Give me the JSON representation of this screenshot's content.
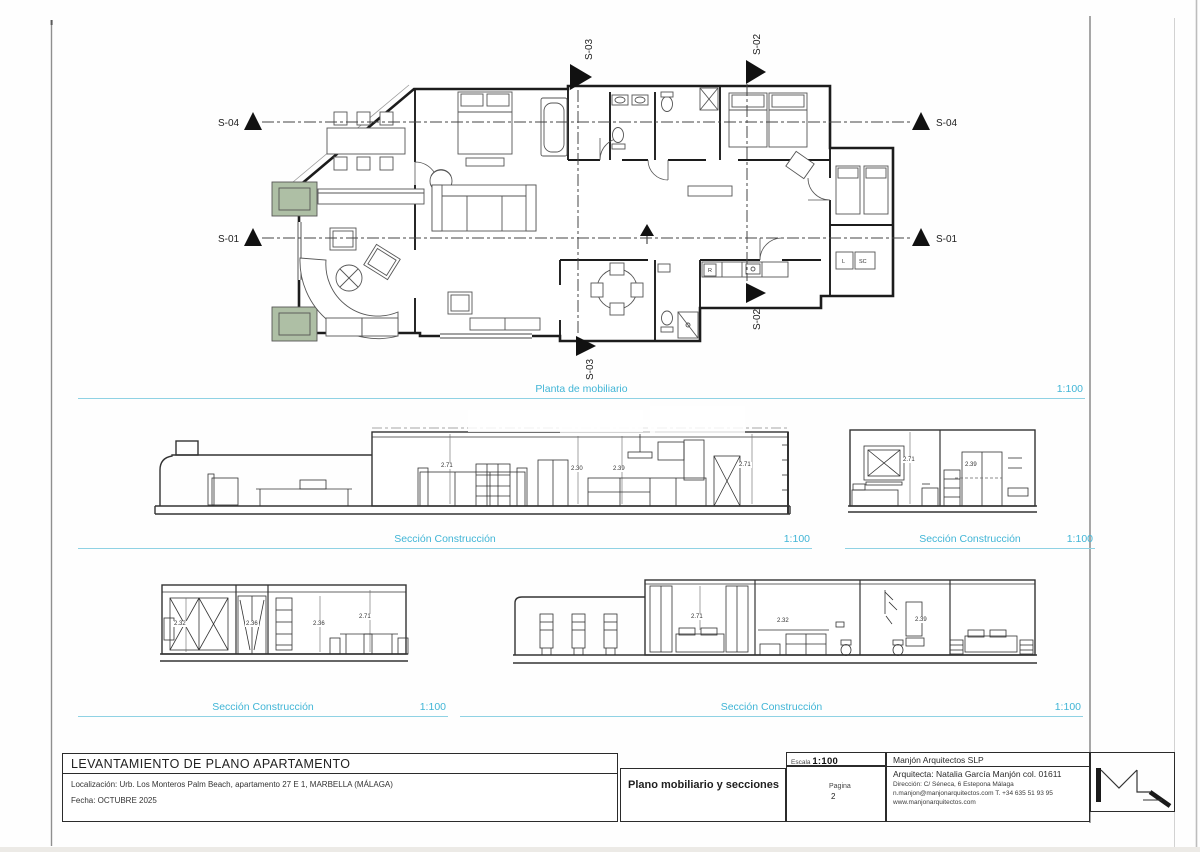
{
  "captions": {
    "plan": {
      "label": "Planta de mobiliario",
      "scale": "1:100"
    },
    "section_a": {
      "label": "Sección Construcción",
      "scale": "1:100"
    },
    "section_b": {
      "label": "Sección Construcción",
      "scale": "1:100"
    },
    "section_c": {
      "label": "Sección Construcción",
      "scale": "1:100"
    },
    "section_d": {
      "label": "Sección Construcción",
      "scale": "1:100"
    }
  },
  "markers": {
    "s01": "S-01",
    "s02": "S-02",
    "s03": "S-03",
    "s04": "S-04"
  },
  "plan_labels": {
    "r": "R",
    "l": "L",
    "sc": "SC"
  },
  "dims": {
    "a": [
      "2.71",
      "2.30",
      "2.39",
      "2.71"
    ],
    "b": [
      "2.71",
      "2.39"
    ],
    "c": [
      "2.32",
      "2.36",
      "2.36",
      "2.71"
    ],
    "d": [
      "2.71",
      "2.32",
      "2.39"
    ]
  },
  "colors": {
    "accent": "#41b5d6",
    "planter": "#aebfa5",
    "ink": "#222222"
  },
  "title_block": {
    "title": "LEVANTAMIENTO DE PLANO APARTAMENTO",
    "location": "Localización:  Urb. Los Monteros Palm Beach, apartamento 27 E 1, MARBELLA (MÁLAGA)",
    "date": "Fecha: OCTUBRE 2025",
    "scale_label": "Escala",
    "scale_value": "1:100",
    "drawing_title": "Plano mobiliario y secciones",
    "page_label": "Pagina",
    "page_number": "2",
    "firm": "Manjón Arquitectos SLP",
    "architect": "Arquitecta: Natalia García Manjón col. 01611",
    "address": "Dirección: C/ Séneca, 6 Estepona Málaga",
    "contact": "n.manjon@manjonarquitectos.com T. +34 635 51 93 95",
    "website": "www.manjonarquitectos.com"
  }
}
